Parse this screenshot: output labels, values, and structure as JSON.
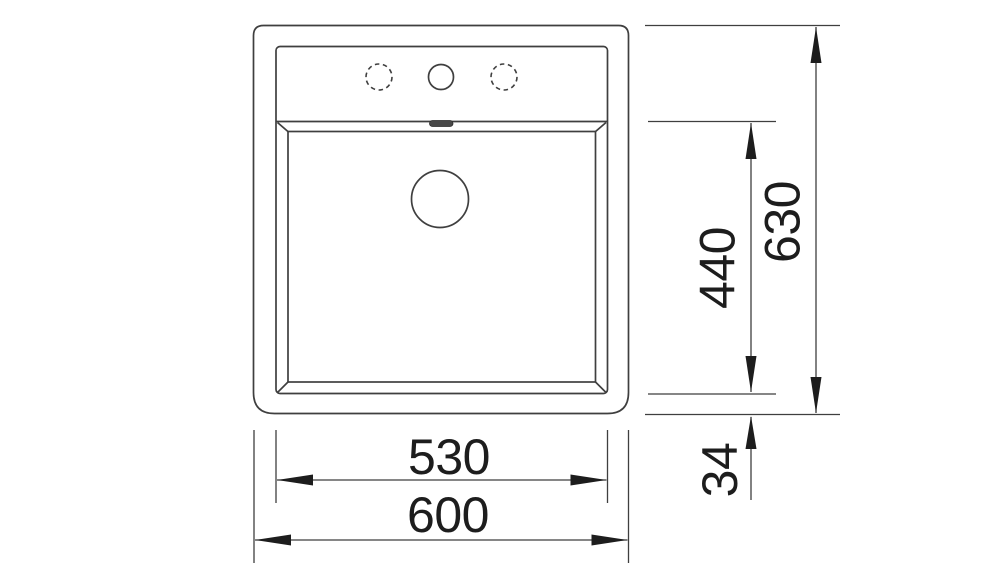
{
  "colors": {
    "line": "#3f3f3f",
    "text": "#1d1d1d",
    "background": "#ffffff",
    "slot": "#484848"
  },
  "drawing": {
    "type": "sink-top-view-technical-drawing",
    "tap_holes": {
      "left": "optional-hole-dashed",
      "center": "tap-hole-solid",
      "right": "optional-hole-dashed"
    },
    "dimensions": {
      "inner_width": {
        "label": "530"
      },
      "outer_width": {
        "label": "600"
      },
      "basin_depth": {
        "label": "440"
      },
      "outer_depth": {
        "label": "630"
      },
      "front_rim": {
        "label": "34"
      }
    }
  }
}
